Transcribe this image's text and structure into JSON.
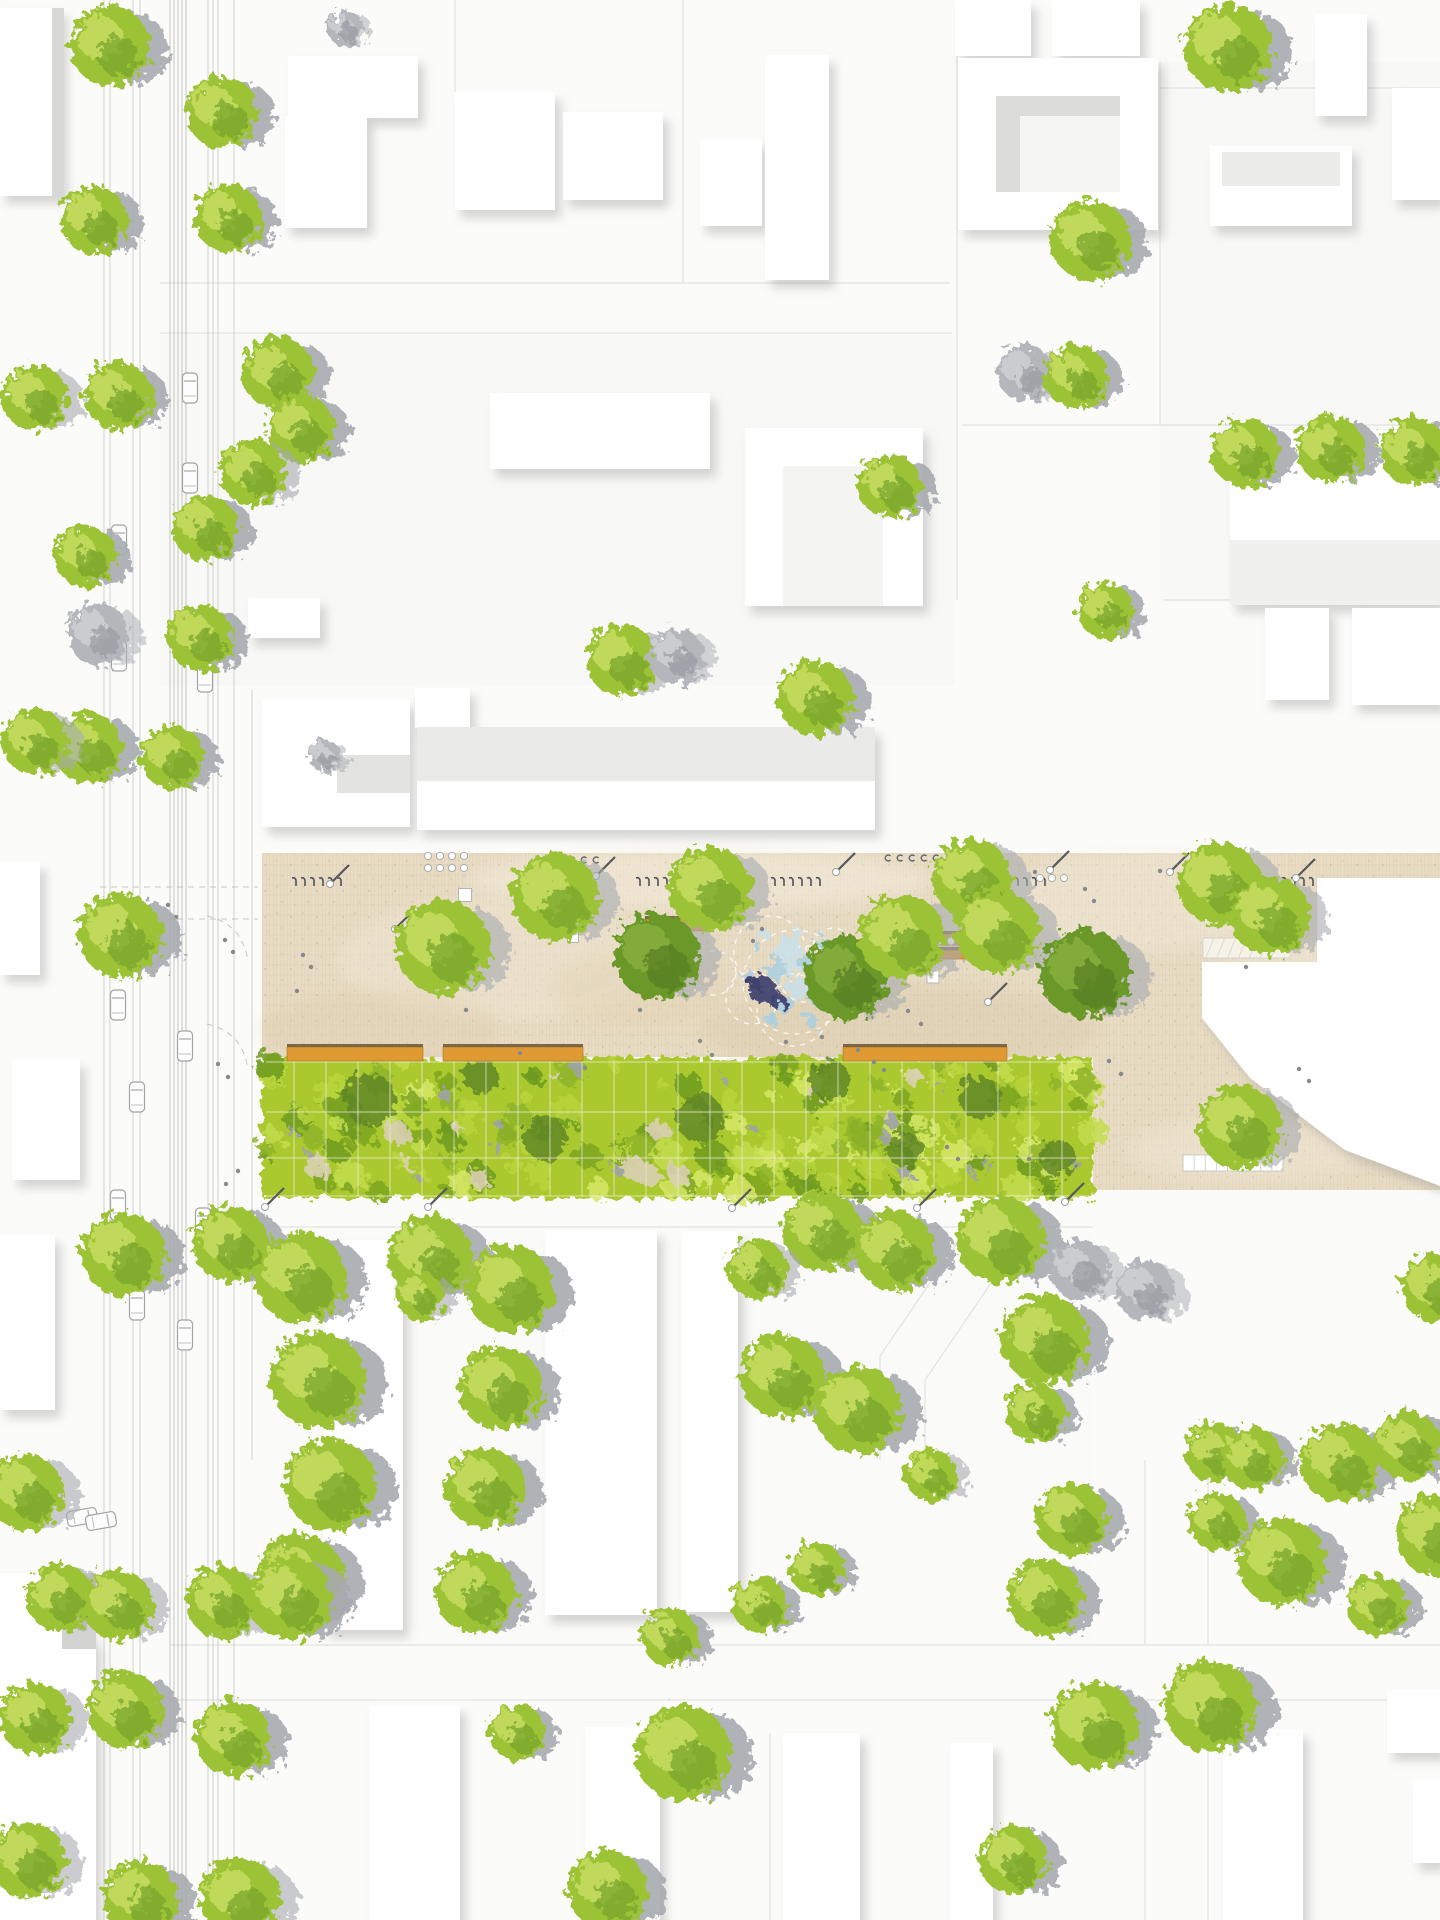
{
  "canvas": {
    "w": 1440,
    "h": 1920,
    "bg": "#fbfbf9"
  },
  "palette": {
    "parcel_line": "#e2e2e0",
    "road_line": "#c6c6c4",
    "tram_line": "#bdbdbb",
    "building_fill": "#ffffff",
    "building_shadow": "#8a8a8a",
    "plaza_base": "#e8dcc5",
    "plaza_stripe": "#dccdb0",
    "plaza_joint": "#c9b794",
    "meadow_base": "#a9c92f",
    "meadow_grid": "#f1ecd8",
    "meadow_edge": "#46521b",
    "tree_green": "#9cc236",
    "tree_green_light": "#c4dc5f",
    "tree_green_dark": "#76a329",
    "tree_darkgreen": "#6b992c",
    "tree_gray": "#b3b7bc",
    "shadow_gray": "#a7abb0",
    "bench_orange": "#df9a33",
    "bench_edge": "#6b5537",
    "water_blue": "#a8cfe2",
    "water_light": "#c8e0ec",
    "water_dark": "#3d416e",
    "car_stroke": "#a3a3a3",
    "people": "#87898c",
    "furniture_dark": "#55585c"
  },
  "parcels": {
    "fills": [
      [
        160,
        335,
        795,
        350,
        "#f8f8f6"
      ],
      [
        1160,
        62,
        280,
        540,
        "#f8f8f6"
      ],
      [
        262,
        1232,
        830,
        410,
        "#fafaf8"
      ],
      [
        960,
        60,
        200,
        172,
        "#fcfcfa"
      ]
    ],
    "lines": [
      "M160 283 H950",
      "M160 333 H952",
      "M957 0 V600",
      "M683 0 V283",
      "M1160 62 V425",
      "M962 425 H1440",
      "M1163 600 H1440",
      "M1160 88 H1440",
      "M262 1227 H1093",
      "M170 1645 H1440",
      "M170 1700 H1440",
      "M1145 1460 V1645",
      "M1208 1460 V1645",
      "M1145 1700 V1920",
      "M1208 1700 V1920",
      "M966 1230 L880 1356 L880 1460",
      "M1008 1258 L925 1380 L925 1460",
      "M455 92 V0",
      "M770 1733 V1920",
      "M1310 430 V605"
    ]
  },
  "road": {
    "vlines": [
      [
        104,
        0,
        1920,
        "n"
      ],
      [
        110,
        0,
        1920,
        "n"
      ],
      [
        133,
        0,
        1920,
        "n"
      ],
      [
        140,
        0,
        1920,
        "n"
      ],
      [
        170,
        0,
        1920,
        "t"
      ],
      [
        174,
        0,
        1920,
        "t"
      ],
      [
        178,
        0,
        1920,
        "t"
      ],
      [
        182,
        0,
        1920,
        "t"
      ],
      [
        186,
        0,
        1920,
        "t"
      ],
      [
        208,
        0,
        1920,
        "n"
      ],
      [
        213,
        0,
        1920,
        "n"
      ],
      [
        218,
        0,
        1920,
        "n"
      ],
      [
        234,
        0,
        1920,
        "n"
      ],
      [
        252,
        690,
        1460,
        "n"
      ]
    ],
    "dashes": [
      "M100 887 H258",
      "M100 919 H258",
      "M207 916 Q243 924 248 962",
      "M207 1024 Q243 1032 248 1070",
      "M262 886 H1440",
      "M262 918 H1440"
    ]
  },
  "plaza": {
    "poly": "262,853 1440,853 1440,1190 1093,1190 1093,1057 262,1057",
    "patches": [
      [
        700,
        880,
        230,
        30,
        "#f3ecdb",
        0.55
      ],
      [
        500,
        960,
        160,
        60,
        "#f1e8d4",
        0.4
      ],
      [
        900,
        1030,
        200,
        45,
        "#d8c6a5",
        0.35
      ],
      [
        1150,
        900,
        140,
        50,
        "#f3ecdb",
        0.4
      ],
      [
        380,
        1030,
        120,
        40,
        "#dcc9a8",
        0.3
      ],
      [
        1250,
        1150,
        120,
        30,
        "#efe7d3",
        0.5
      ],
      [
        640,
        990,
        90,
        40,
        "#e0cfae",
        0.3
      ],
      [
        1300,
        1000,
        90,
        60,
        "#f2ead8",
        0.45
      ]
    ],
    "ramp": {
      "x": 1203,
      "y": 938,
      "w": 87,
      "h": 20
    },
    "pergola": {
      "x": 1183,
      "y": 1155,
      "w": 100,
      "h": 16,
      "cells": 9
    },
    "squares": [
      [
        465,
        895,
        13
      ],
      [
        573,
        937,
        11
      ],
      [
        933,
        977,
        12
      ]
    ],
    "racks": [
      [
        296,
        879
      ],
      [
        640,
        879
      ],
      [
        775,
        879
      ],
      [
        1000,
        879
      ],
      [
        1268,
        879
      ]
    ],
    "poles": [
      [
        330,
        884
      ],
      [
        596,
        876
      ],
      [
        836,
        872
      ],
      [
        1050,
        870
      ],
      [
        1170,
        872
      ],
      [
        1296,
        878
      ],
      [
        395,
        929
      ],
      [
        988,
        1002
      ],
      [
        265,
        1207
      ],
      [
        428,
        1207
      ],
      [
        732,
        1208
      ],
      [
        917,
        1208
      ],
      [
        1065,
        1202
      ]
    ],
    "chair_circle_rows": [
      {
        "x": 428,
        "y": 856,
        "cols": 4,
        "rows": 2,
        "dx": 12,
        "dy": 12,
        "r": 3.6
      },
      {
        "x": 925,
        "y": 941,
        "cols": 4,
        "rows": 1,
        "dx": 13,
        "dy": 0,
        "r": 4
      },
      {
        "x": 1040,
        "y": 878,
        "cols": 3,
        "rows": 1,
        "dx": 12,
        "dy": 0,
        "r": 3.6
      }
    ],
    "chair_loop_rows": [
      {
        "x": 548,
        "y": 860,
        "cols": 5,
        "dx": 12
      },
      {
        "x": 888,
        "y": 858,
        "cols": 5,
        "dx": 12
      }
    ]
  },
  "meadow": {
    "x": 262,
    "y": 1057,
    "w": 831,
    "h": 141,
    "grid": {
      "vx0": 294,
      "vstep": 32,
      "vx1": 1082,
      "hy": [
        1062,
        1112,
        1158,
        1196
      ]
    },
    "blob_seed": 7,
    "blob_count": 170,
    "rock_count": 18,
    "gap_count": 14,
    "darks": [
      [
        370,
        1100,
        26
      ],
      [
        545,
        1138,
        22
      ],
      [
        700,
        1118,
        24
      ],
      [
        980,
        1098,
        22
      ],
      [
        1058,
        1158,
        18
      ],
      [
        480,
        1075,
        18
      ],
      [
        830,
        1080,
        20
      ],
      [
        905,
        1150,
        18
      ]
    ]
  },
  "fountain": {
    "cx": 795,
    "cy": 980,
    "circles": [
      [
        770,
        952,
        36
      ],
      [
        806,
        974,
        28
      ],
      [
        752,
        998,
        26
      ],
      [
        793,
        1010,
        36
      ],
      [
        833,
        948,
        20
      ],
      [
        714,
        973,
        22
      ],
      [
        795,
        982,
        52
      ]
    ],
    "splashes": [
      [
        788,
        948,
        13
      ],
      [
        809,
        963,
        10
      ],
      [
        777,
        969,
        11
      ],
      [
        799,
        989,
        11
      ],
      [
        784,
        1004,
        9
      ],
      [
        817,
        999,
        8
      ],
      [
        764,
        934,
        7
      ],
      [
        834,
        984,
        7
      ],
      [
        747,
        974,
        6
      ],
      [
        799,
        934,
        6
      ],
      [
        771,
        1019,
        7
      ],
      [
        811,
        1021,
        6
      ],
      [
        837,
        1011,
        5
      ],
      [
        757,
        947,
        5
      ],
      [
        822,
        942,
        6
      ],
      [
        792,
        968,
        8
      ]
    ],
    "dark_blobs": [
      [
        763,
        991,
        14
      ],
      [
        777,
        1000,
        8
      ],
      [
        755,
        983,
        6
      ]
    ]
  },
  "benches": [
    [
      287,
      1047,
      136,
      14
    ],
    [
      443,
      1047,
      140,
      14
    ],
    [
      843,
      1047,
      164,
      14
    ],
    [
      645,
      919,
      60,
      12
    ],
    [
      640,
      937,
      33,
      10
    ],
    [
      940,
      934,
      46,
      11
    ],
    [
      938,
      950,
      30,
      9
    ]
  ],
  "buildings": {
    "rects": [
      [
        0,
        8,
        62,
        188
      ],
      [
        288,
        56,
        130,
        62
      ],
      [
        285,
        116,
        82,
        112
      ],
      [
        455,
        92,
        100,
        118
      ],
      [
        563,
        112,
        100,
        88
      ],
      [
        700,
        140,
        62,
        86
      ],
      [
        765,
        55,
        64,
        225
      ],
      [
        955,
        0,
        76,
        56
      ],
      [
        1052,
        0,
        88,
        56
      ],
      [
        958,
        58,
        200,
        172
      ],
      [
        1315,
        14,
        52,
        102
      ],
      [
        1210,
        146,
        142,
        80
      ],
      [
        1392,
        88,
        48,
        112
      ],
      [
        490,
        393,
        220,
        76
      ],
      [
        745,
        428,
        178,
        178
      ],
      [
        1230,
        430,
        210,
        175
      ],
      [
        1265,
        608,
        64,
        92
      ],
      [
        1352,
        608,
        88,
        97
      ],
      [
        262,
        700,
        148,
        127
      ],
      [
        417,
        727,
        458,
        103
      ],
      [
        415,
        688,
        55,
        40
      ],
      [
        248,
        598,
        72,
        40
      ],
      [
        1317,
        878,
        123,
        86
      ],
      [
        323,
        1240,
        80,
        390
      ],
      [
        545,
        1230,
        112,
        385
      ],
      [
        681,
        1231,
        57,
        381
      ],
      [
        12,
        1060,
        68,
        120
      ],
      [
        0,
        1235,
        55,
        175
      ],
      [
        0,
        862,
        40,
        113
      ],
      [
        370,
        1705,
        90,
        215
      ],
      [
        585,
        1727,
        75,
        193
      ],
      [
        783,
        1733,
        77,
        187
      ],
      [
        950,
        1743,
        43,
        177
      ],
      [
        1223,
        1730,
        80,
        190
      ],
      [
        1413,
        1780,
        27,
        83
      ],
      [
        1387,
        1690,
        53,
        63
      ]
    ],
    "polys": [
      "1202,962 1440,962 1440,1186 1345,1150 1300,1116 1250,1078 1218,1038 1202,1018",
      "0,1573 62,1573 96,1645 96,1920 0,1920"
    ],
    "shades": [
      [
        996,
        96,
        124,
        96,
        "#f5f5f3"
      ],
      [
        996,
        96,
        124,
        20,
        "#dcdcda"
      ],
      [
        996,
        96,
        24,
        96,
        "#dcdcda"
      ],
      [
        337,
        755,
        73,
        38,
        "#e3e3e1"
      ],
      [
        417,
        727,
        458,
        54,
        "#eaeae8"
      ],
      [
        1230,
        540,
        210,
        65,
        "#f0f0ee"
      ],
      [
        783,
        466,
        100,
        140,
        "#f4f4f2"
      ],
      [
        1222,
        152,
        118,
        34,
        "#ececea"
      ],
      [
        52,
        8,
        12,
        188,
        "#d8d8d6"
      ],
      [
        62,
        1573,
        34,
        76,
        "#d2d2d0"
      ]
    ]
  },
  "cars": [
    [
      190,
      388,
      0
    ],
    [
      190,
      478,
      0
    ],
    [
      119,
      540,
      0
    ],
    [
      119,
      656,
      0
    ],
    [
      205,
      677,
      0
    ],
    [
      118,
      1005,
      0
    ],
    [
      185,
      1046,
      0
    ],
    [
      137,
      1097,
      0
    ],
    [
      118,
      1205,
      0
    ],
    [
      203,
      1223,
      0
    ],
    [
      137,
      1305,
      0
    ],
    [
      185,
      1335,
      0
    ],
    [
      82,
      1517,
      80
    ],
    [
      101,
      1521,
      80
    ]
  ],
  "people": [
    [
      303,
      955
    ],
    [
      311,
      967
    ],
    [
      297,
      991
    ],
    [
      466,
      1010
    ],
    [
      520,
      1053
    ],
    [
      585,
      1068
    ],
    [
      640,
      1010
    ],
    [
      700,
      1041
    ],
    [
      712,
      1055
    ],
    [
      753,
      941
    ],
    [
      762,
      929
    ],
    [
      786,
      1042
    ],
    [
      822,
      1037
    ],
    [
      858,
      1050
    ],
    [
      871,
      1009
    ],
    [
      886,
      961
    ],
    [
      894,
      947
    ],
    [
      908,
      1011
    ],
    [
      921,
      1024
    ],
    [
      941,
      871
    ],
    [
      953,
      880
    ],
    [
      1085,
      889
    ],
    [
      1094,
      901
    ],
    [
      1109,
      1061
    ],
    [
      1121,
      1074
    ],
    [
      1160,
      871
    ],
    [
      1246,
      967
    ],
    [
      1299,
      1069
    ],
    [
      1309,
      1081
    ],
    [
      947,
      1147
    ],
    [
      958,
      1159
    ],
    [
      1029,
      1159
    ],
    [
      739,
      879
    ],
    [
      748,
      891
    ],
    [
      1035,
      872
    ],
    [
      225,
      940
    ],
    [
      233,
      952
    ],
    [
      218,
      1064
    ],
    [
      228,
      1077
    ],
    [
      238,
      1171
    ],
    [
      226,
      1184
    ],
    [
      168,
      905
    ],
    [
      176,
      917
    ],
    [
      907,
      929
    ],
    [
      916,
      938
    ],
    [
      874,
      1062
    ],
    [
      884,
      1070
    ]
  ],
  "trees": [
    [
      110,
      46,
      40,
      "m"
    ],
    [
      222,
      112,
      36,
      "m"
    ],
    [
      228,
      218,
      34,
      "m"
    ],
    [
      94,
      220,
      34,
      "m"
    ],
    [
      345,
      28,
      18,
      "y"
    ],
    [
      35,
      398,
      33,
      "g"
    ],
    [
      118,
      396,
      34,
      "m"
    ],
    [
      278,
      373,
      36,
      "m"
    ],
    [
      300,
      428,
      34,
      "m"
    ],
    [
      252,
      472,
      33,
      "g"
    ],
    [
      205,
      528,
      33,
      "m"
    ],
    [
      85,
      556,
      31,
      "m"
    ],
    [
      98,
      634,
      31,
      "y"
    ],
    [
      200,
      638,
      33,
      "m"
    ],
    [
      88,
      748,
      35,
      "m"
    ],
    [
      172,
      757,
      32,
      "m"
    ],
    [
      35,
      742,
      33,
      "g"
    ],
    [
      325,
      756,
      16,
      "y"
    ],
    [
      622,
      660,
      36,
      "g"
    ],
    [
      676,
      656,
      28,
      "y"
    ],
    [
      815,
      698,
      38,
      "m"
    ],
    [
      1090,
      240,
      40,
      "m"
    ],
    [
      1228,
      48,
      44,
      "m"
    ],
    [
      1025,
      373,
      28,
      "y"
    ],
    [
      1076,
      377,
      32,
      "m"
    ],
    [
      1245,
      453,
      34,
      "m"
    ],
    [
      1330,
      449,
      34,
      "m"
    ],
    [
      1414,
      452,
      34,
      "m"
    ],
    [
      890,
      486,
      32,
      "m"
    ],
    [
      1105,
      610,
      28,
      "m"
    ],
    [
      120,
      935,
      42,
      "m"
    ],
    [
      555,
      897,
      44,
      "g"
    ],
    [
      443,
      947,
      47,
      "g"
    ],
    [
      657,
      956,
      43,
      "d"
    ],
    [
      710,
      889,
      42,
      "g"
    ],
    [
      846,
      977,
      42,
      "d"
    ],
    [
      902,
      937,
      43,
      "g"
    ],
    [
      972,
      879,
      40,
      "g"
    ],
    [
      997,
      931,
      42,
      "g"
    ],
    [
      1085,
      974,
      45,
      "d"
    ],
    [
      1220,
      884,
      42,
      "g"
    ],
    [
      1270,
      916,
      40,
      "g"
    ],
    [
      1240,
      1127,
      42,
      "g"
    ],
    [
      123,
      1254,
      42,
      "m"
    ],
    [
      230,
      1244,
      38,
      "m"
    ],
    [
      430,
      1257,
      42,
      "m"
    ],
    [
      420,
      1296,
      24,
      "g"
    ],
    [
      823,
      1232,
      40,
      "m"
    ],
    [
      895,
      1251,
      40,
      "m"
    ],
    [
      1000,
      1240,
      44,
      "m"
    ],
    [
      1080,
      1270,
      30,
      "y"
    ],
    [
      1435,
      1288,
      34,
      "m"
    ],
    [
      300,
      1277,
      46,
      "m"
    ],
    [
      318,
      1380,
      48,
      "m"
    ],
    [
      330,
      1485,
      46,
      "m"
    ],
    [
      300,
      1578,
      44,
      "m"
    ],
    [
      510,
      1289,
      44,
      "m"
    ],
    [
      500,
      1388,
      42,
      "m"
    ],
    [
      485,
      1488,
      40,
      "m"
    ],
    [
      475,
      1593,
      40,
      "m"
    ],
    [
      757,
      1269,
      30,
      "g"
    ],
    [
      782,
      1376,
      42,
      "m"
    ],
    [
      858,
      1410,
      44,
      "m"
    ],
    [
      931,
      1475,
      26,
      "g"
    ],
    [
      1045,
      1340,
      44,
      "m"
    ],
    [
      1145,
      1290,
      30,
      "y"
    ],
    [
      25,
      1492,
      38,
      "g"
    ],
    [
      60,
      1598,
      34,
      "g"
    ],
    [
      118,
      1605,
      35,
      "g"
    ],
    [
      222,
      1602,
      36,
      "g"
    ],
    [
      290,
      1598,
      42,
      "m"
    ],
    [
      125,
      1710,
      38,
      "m"
    ],
    [
      233,
      1738,
      38,
      "m"
    ],
    [
      35,
      1718,
      36,
      "g"
    ],
    [
      28,
      1860,
      38,
      "g"
    ],
    [
      140,
      1898,
      38,
      "m"
    ],
    [
      240,
      1898,
      40,
      "g"
    ],
    [
      1035,
      1413,
      30,
      "m"
    ],
    [
      1072,
      1519,
      36,
      "m"
    ],
    [
      1045,
      1598,
      38,
      "m"
    ],
    [
      1215,
      1453,
      30,
      "m"
    ],
    [
      1252,
      1458,
      31,
      "m"
    ],
    [
      1217,
      1521,
      29,
      "m"
    ],
    [
      1282,
      1562,
      44,
      "m"
    ],
    [
      1340,
      1463,
      40,
      "m"
    ],
    [
      1408,
      1446,
      34,
      "m"
    ],
    [
      1377,
      1605,
      31,
      "m"
    ],
    [
      1094,
      1726,
      44,
      "m"
    ],
    [
      1210,
      1706,
      46,
      "m"
    ],
    [
      1435,
      1535,
      40,
      "m"
    ],
    [
      683,
      1753,
      48,
      "m"
    ],
    [
      670,
      1637,
      29,
      "m"
    ],
    [
      760,
      1605,
      28,
      "m"
    ],
    [
      817,
      1569,
      27,
      "m"
    ],
    [
      517,
      1732,
      28,
      "m"
    ],
    [
      608,
      1890,
      40,
      "m"
    ],
    [
      1013,
      1860,
      34,
      "m"
    ]
  ]
}
